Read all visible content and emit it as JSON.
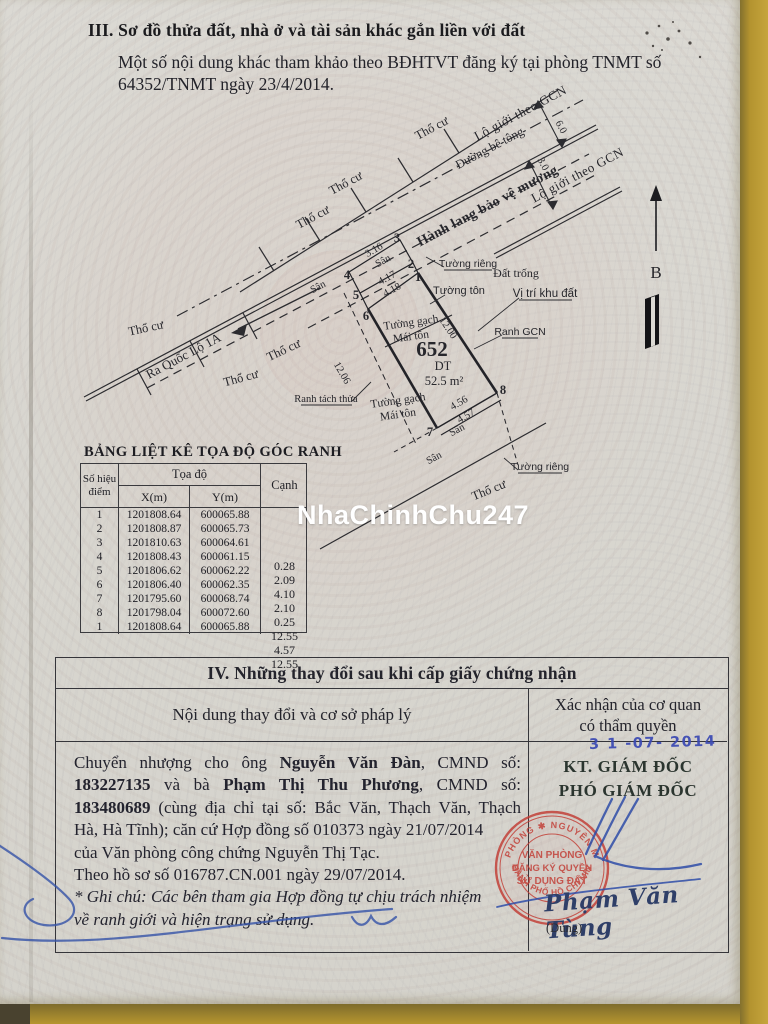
{
  "watermark": "NhaChinhChu247",
  "header": {
    "title": "III. Sơ đồ thửa đất, nhà ở và tài sản khác gắn liền với đất",
    "note1": "Một số nội dung khác tham khảo theo BĐHTVT đăng ký tại phòng TNMT số",
    "note2": "64352/TNMT ngày 23/4/2014."
  },
  "diagram": {
    "lo_gioi": "Lộ giới theo GCN",
    "duong_be_tong": "Đường bê tông",
    "hanh_lang": "Hành lang bảo vệ mương",
    "ra_quoc_lo": "Ra Quốc Lộ 1A",
    "tho_cu": "Thổ cư",
    "san": "Sân",
    "tuong_rieng": "Tường riêng",
    "tuong_ton": "Tường tôn",
    "dat_trong": "Đất trống",
    "vi_tri": "Vị trí khu đất",
    "ranh_gcn": "Ranh GCN",
    "ranh_tach": "Ranh tách thửa",
    "tuong_gach": "Tường gạch",
    "mai_ton": "Mái tôn",
    "plot_number": "652",
    "dt_label": "DT",
    "area": "52.5 m²",
    "compass": "B",
    "points": [
      "1",
      "2",
      "3",
      "4",
      "5",
      "6",
      "7",
      "8"
    ],
    "dims": {
      "d316": "3.16",
      "d417": "4.17",
      "d418": "4.18",
      "d1200": "12.00",
      "d1206": "12.06",
      "d456": "4.56",
      "d457": "4.57",
      "d60": "6.0",
      "d30": "3.0"
    }
  },
  "table": {
    "title": "BẢNG LIỆT KÊ TỌA ĐỘ GÓC RANH",
    "col_point_1": "Số hiệu",
    "col_point_2": "điểm",
    "col_coords": "Tọa độ",
    "col_x": "X(m)",
    "col_y": "Y(m)",
    "col_edge": "Cạnh",
    "rows": [
      {
        "p": "1",
        "x": "1201808.64",
        "y": "600065.88"
      },
      {
        "p": "2",
        "x": "1201808.87",
        "y": "600065.73"
      },
      {
        "p": "3",
        "x": "1201810.63",
        "y": "600064.61"
      },
      {
        "p": "4",
        "x": "1201808.43",
        "y": "600061.15"
      },
      {
        "p": "5",
        "x": "1201806.62",
        "y": "600062.22"
      },
      {
        "p": "6",
        "x": "1201806.40",
        "y": "600062.35"
      },
      {
        "p": "7",
        "x": "1201795.60",
        "y": "600068.74"
      },
      {
        "p": "8",
        "x": "1201798.04",
        "y": "600072.60"
      },
      {
        "p": "1",
        "x": "1201808.64",
        "y": "600065.88"
      }
    ],
    "edges": [
      "0.28",
      "2.09",
      "4.10",
      "2.10",
      "0.25",
      "12.55",
      "4.57",
      "12.55"
    ]
  },
  "section4": {
    "title": "IV. Những thay đổi sau khi cấp giấy chứng nhận",
    "col_left": "Nội dung thay đổi và cơ sở pháp lý",
    "col_right_1": "Xác nhận của cơ quan",
    "col_right_2": "có thẩm quyền",
    "date_stamp": "3 1 -07- 2014",
    "kt": "KT. GIÁM ĐỐC",
    "pho": "PHÓ GIÁM ĐỐC",
    "signature_name": "Phạm Văn Tùng",
    "signature_sub": "(Dung)",
    "stamp": {
      "l1": "VĂN PHÒNG",
      "l2": "ĐĂNG KÝ QUYỀN",
      "l3": "SỬ DỤNG ĐẤT",
      "ring_top": "PHÒNG ✱ NGUYÊN M",
      "ring_bottom": "THÀNH PHỐ HỒ CHÍ MINH"
    },
    "body": {
      "l1a": "Chuyển nhượng cho ông",
      "l1b": "Nguyễn Văn Đàn",
      "l1c": ", CMND số:",
      "l2a": "183227135",
      "l2b": "và bà",
      "l2c": "Phạm Thị Thu Phương",
      "l2d": ", CMND số:",
      "l3a": "183480689",
      "l3b": "(cùng địa chỉ tại số: Bắc Văn, Thạch Văn, Thạch",
      "l4": "Hà, Hà Tĩnh); căn cứ Hợp đồng số 010373 ngày 21/07/2014",
      "l5": "của Văn phòng công chứng Nguyễn Thị Tạc.",
      "l6": "Theo hồ sơ số 016787.CN.001 ngày 29/07/2014.",
      "note1": "* Ghi chú: Các bên tham gia Hợp đồng tự chịu trách nhiệm",
      "note2": "về ranh giới và hiện trạng sử dụng."
    }
  }
}
